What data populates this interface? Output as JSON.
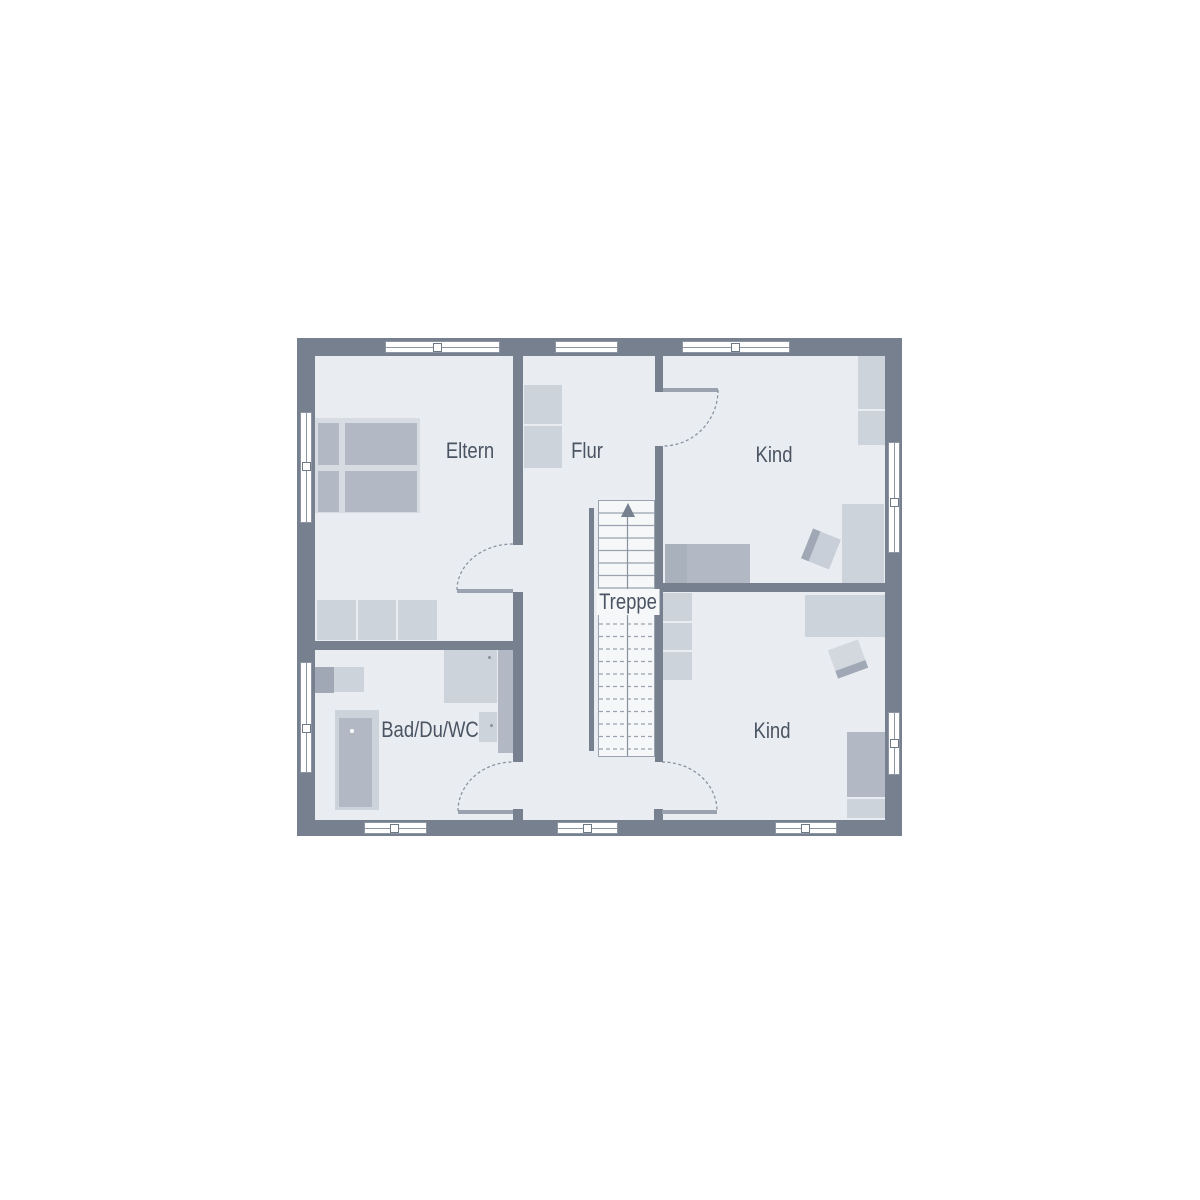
{
  "labels": {
    "eltern": "Eltern",
    "flur": "Flur",
    "kind_top": "Kind",
    "kind_bottom": "Kind",
    "treppe": "Treppe",
    "bad": "Bad/Du/WC"
  },
  "colors": {
    "wall": "#76808E",
    "room_fill": "#E9EDF2",
    "stairs_fill": "#F5F7F9",
    "furniture_light": "#CDD3DB",
    "furniture_medium": "#B2B9C4",
    "furniture_dark": "#A9B1BC",
    "furniture_deep": "#9FA8B4",
    "bed_frame": "#D7DBE2",
    "window_line": "#8C95A1",
    "handle_line": "#6E7987",
    "door_leaf": "#9AA3AF",
    "arc_line": "#8A93A0",
    "label_text": "#4A5462"
  }
}
